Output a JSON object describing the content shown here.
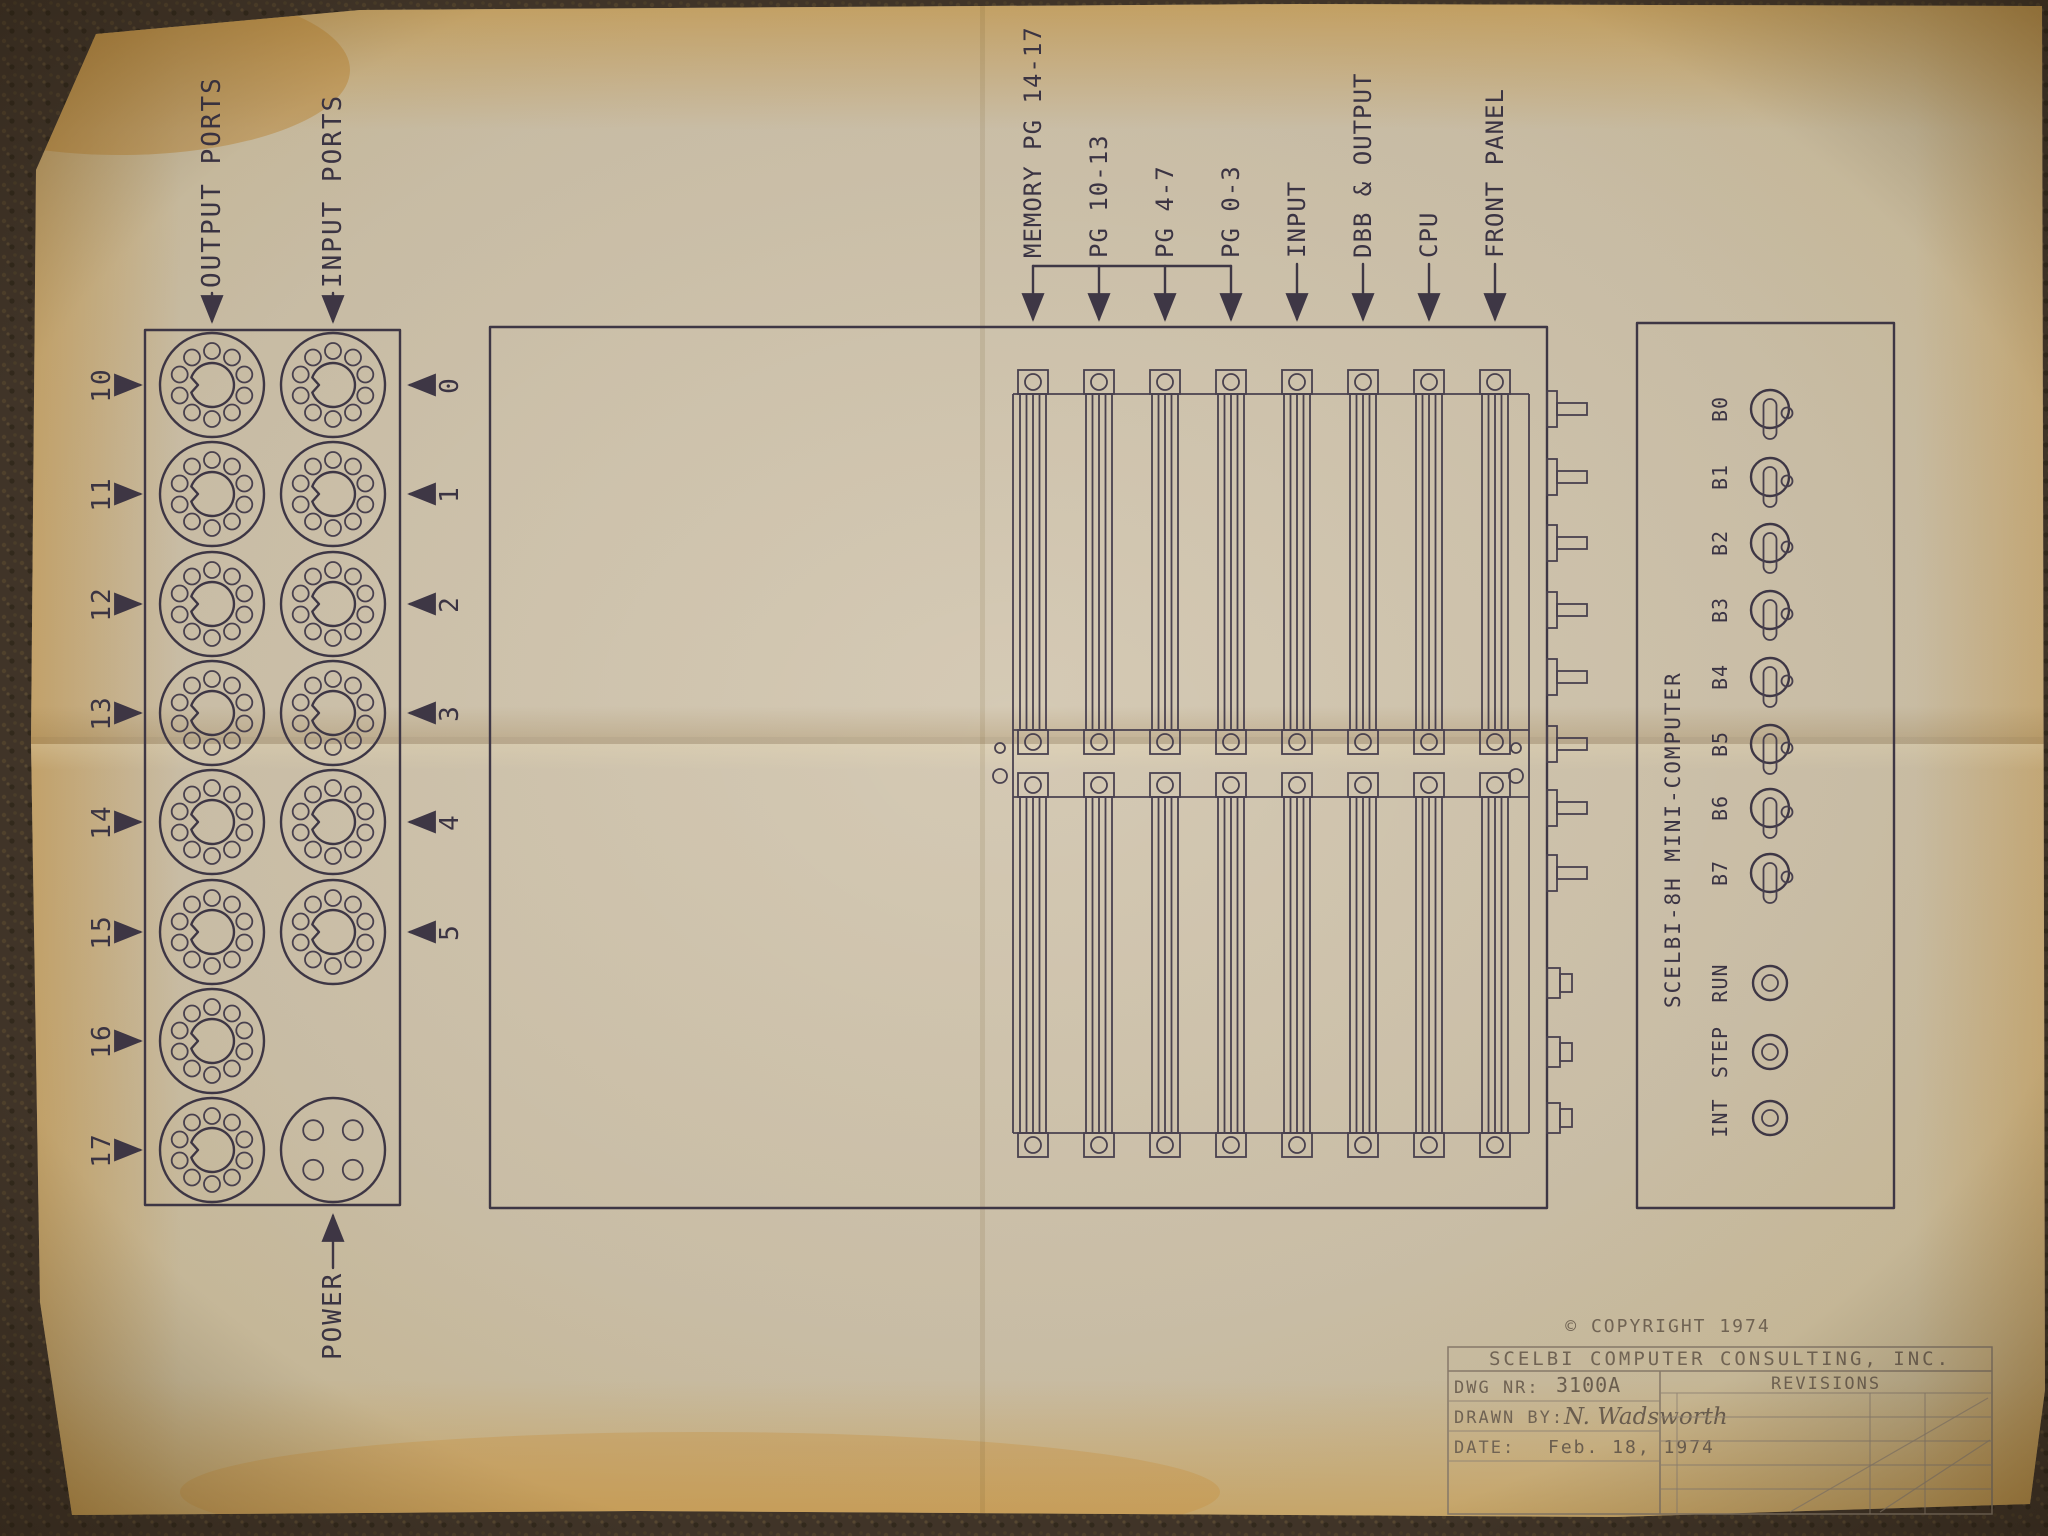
{
  "labels": {
    "output_ports": "OUTPUT PORTS",
    "input_ports": "INPUT PORTS",
    "power": "POWER"
  },
  "output_port_numbers": [
    "10",
    "11",
    "12",
    "13",
    "14",
    "15",
    "16",
    "17"
  ],
  "input_port_numbers": [
    "0",
    "1",
    "2",
    "3",
    "4",
    "5"
  ],
  "slot_labels": [
    "MEMORY PG 14-17",
    "PG 10-13",
    "PG 4-7",
    "PG 0-3",
    "INPUT",
    "DBB & OUTPUT",
    "CPU",
    "FRONT PANEL"
  ],
  "front_panel": {
    "model": "SCELBI-8H MINI-COMPUTER",
    "switches": [
      "B0",
      "B1",
      "B2",
      "B3",
      "B4",
      "B5",
      "B6",
      "B7"
    ],
    "buttons": [
      "RUN",
      "STEP",
      "INT"
    ]
  },
  "title_block": {
    "copyright": "© COPYRIGHT 1974",
    "company": "SCELBI COMPUTER CONSULTING, INC.",
    "dwg_nr_label": "DWG NR:",
    "dwg_nr": "3100A",
    "drawn_by_label": "DRAWN BY:",
    "drawn_by": "N. Wadsworth",
    "date_label": "DATE:",
    "date": "Feb. 18, 1974",
    "revisions": "REVISIONS"
  },
  "colors": {
    "paper": "#d0c4ad",
    "paper_aged_edge": "#cfae6d",
    "ink": "#3f3847",
    "pencil": "#8a7d6d",
    "carpet": "#42362a"
  }
}
